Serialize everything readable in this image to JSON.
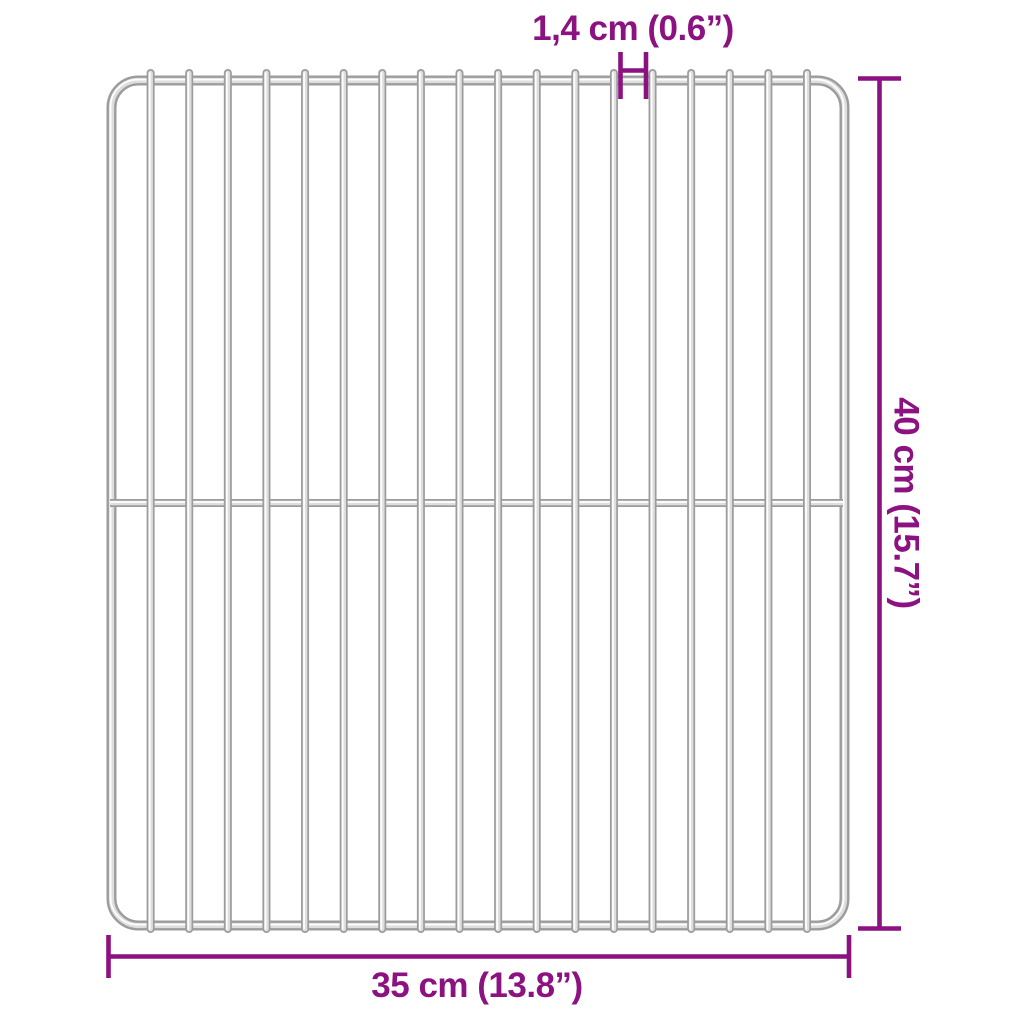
{
  "image": {
    "description": "Stainless steel BBQ grill grate shown on white background with dimension annotations"
  },
  "colors": {
    "accent": "#8C1181",
    "wire_dark": "#9c9c9c",
    "wire_mid": "#dedede",
    "wire_highlight": "#ffffff"
  },
  "grate": {
    "vertical_bars": 18,
    "cross_bars": 1
  },
  "dimensions": {
    "gap_label": "1,4 cm (0.6”)",
    "height_label": "40 cm (15.7”)",
    "width_label": "35 cm (13.8”)"
  }
}
